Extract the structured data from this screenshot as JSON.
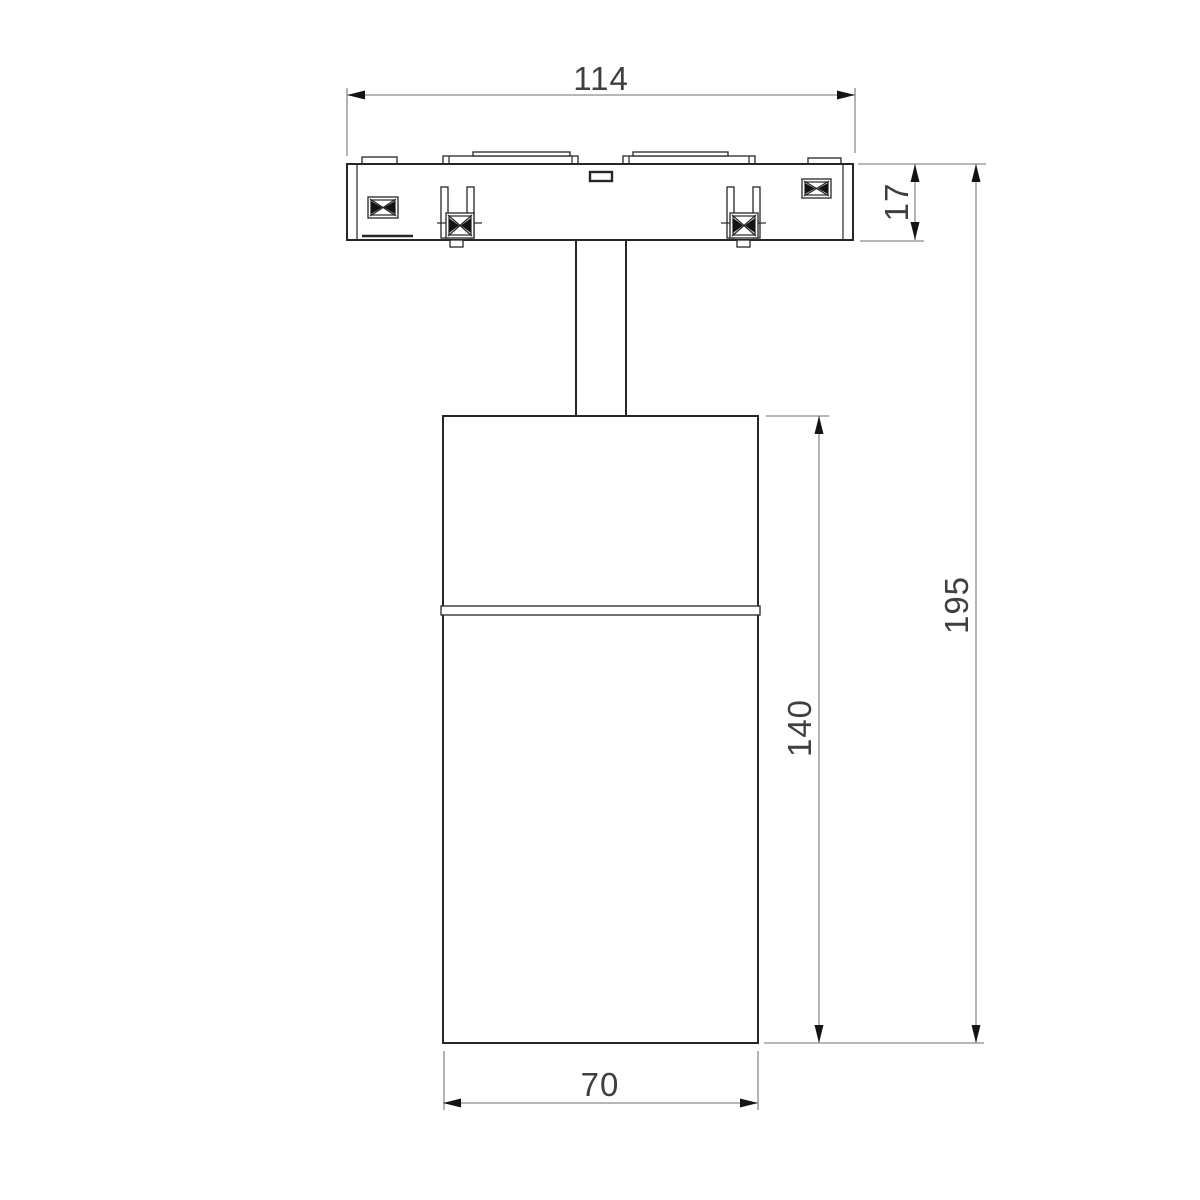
{
  "drawing": {
    "dimensions": {
      "track_width": "114",
      "adapter_height": "17",
      "overall_height": "195",
      "body_height": "140",
      "body_width": "70"
    },
    "colors": {
      "outline": "#262626",
      "dimension": "#8c8c8c",
      "arrow": "#141414",
      "text": "#3f3f3f",
      "background": "#ffffff"
    }
  }
}
